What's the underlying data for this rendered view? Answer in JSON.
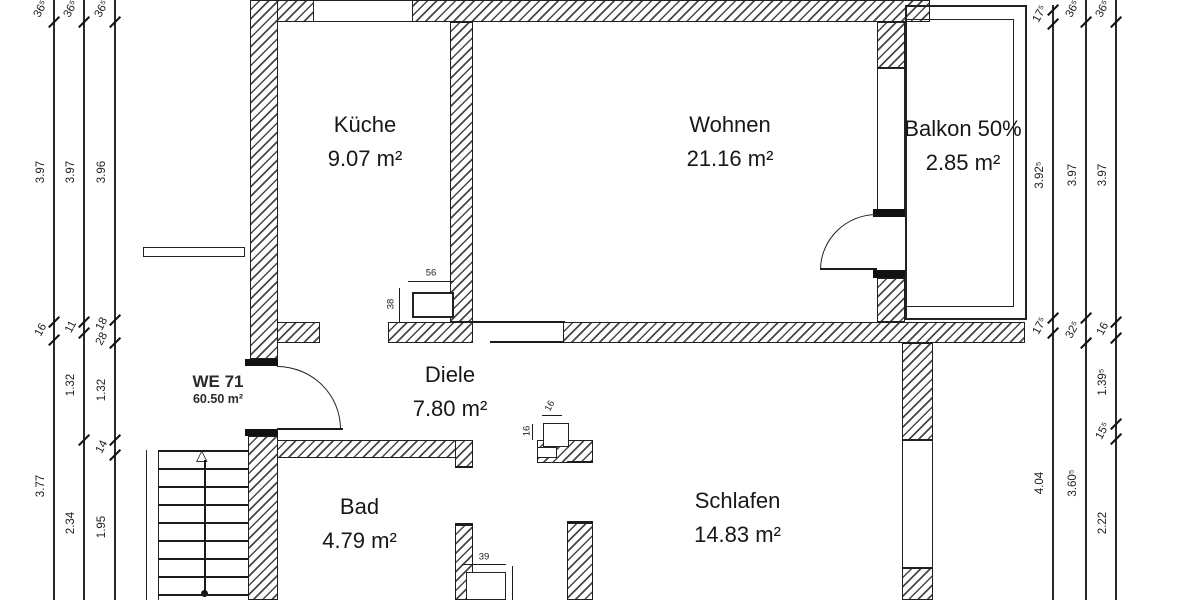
{
  "plan_title": "Wohnungsgrundriss WE 71",
  "rooms": [
    {
      "id": "kueche",
      "name": "Küche",
      "area": "9.07 m²"
    },
    {
      "id": "wohnen",
      "name": "Wohnen",
      "area": "21.16 m²"
    },
    {
      "id": "balkon",
      "name": "Balkon 50%",
      "area": "2.85 m²"
    },
    {
      "id": "diele",
      "name": "Diele",
      "area": "7.80 m²"
    },
    {
      "id": "bad",
      "name": "Bad",
      "area": "4.79 m²"
    },
    {
      "id": "schlafen",
      "name": "Schlafen",
      "area": "14.83 m²"
    }
  ],
  "unit": {
    "label": "WE 71",
    "area": "60.50 m²"
  },
  "dimensions": [
    {
      "side": "left",
      "x": 53,
      "top": 0,
      "bottom": 600,
      "ticks": [
        22,
        322,
        340
      ],
      "labels": [
        {
          "t": "36⁵",
          "y": 9
        },
        {
          "t": "3.97",
          "y": 172
        },
        {
          "t": "16",
          "y": 330
        },
        {
          "t": "3.77",
          "y": 486
        }
      ]
    },
    {
      "side": "left",
      "x": 83,
      "top": 0,
      "bottom": 600,
      "ticks": [
        22,
        322,
        333,
        440
      ],
      "labels": [
        {
          "t": "36⁵",
          "y": 9
        },
        {
          "t": "3.97",
          "y": 172
        },
        {
          "t": "11",
          "y": 327
        },
        {
          "t": "1.32",
          "y": 385
        },
        {
          "t": "2.34",
          "y": 523
        }
      ]
    },
    {
      "side": "left",
      "x": 114,
      "top": 0,
      "bottom": 600,
      "ticks": [
        22,
        320,
        343,
        440,
        455
      ],
      "labels": [
        {
          "t": "36⁵",
          "y": 9
        },
        {
          "t": "3.96",
          "y": 172
        },
        {
          "t": "18",
          "y": 324
        },
        {
          "t": "28",
          "y": 339
        },
        {
          "t": "1.32",
          "y": 390
        },
        {
          "t": "14",
          "y": 447
        },
        {
          "t": "1.95",
          "y": 527
        }
      ]
    },
    {
      "side": "right",
      "x": 1052,
      "top": 5,
      "bottom": 600,
      "ticks": [
        10,
        24,
        318,
        333
      ],
      "labels": [
        {
          "t": "17⁵",
          "y": 14
        },
        {
          "t": "3.92⁵",
          "y": 175
        },
        {
          "t": "17⁵",
          "y": 326
        },
        {
          "t": "4.04",
          "y": 483
        }
      ]
    },
    {
      "side": "right",
      "x": 1085,
      "top": 0,
      "bottom": 600,
      "ticks": [
        22,
        318,
        343
      ],
      "labels": [
        {
          "t": "36⁵",
          "y": 9
        },
        {
          "t": "3.97",
          "y": 175
        },
        {
          "t": "32⁵",
          "y": 330
        },
        {
          "t": "3.60⁵",
          "y": 483
        }
      ]
    },
    {
      "side": "right",
      "x": 1115,
      "top": 0,
      "bottom": 600,
      "ticks": [
        22,
        322,
        338,
        424,
        439
      ],
      "labels": [
        {
          "t": "36⁵",
          "y": 9
        },
        {
          "t": "3.97",
          "y": 175
        },
        {
          "t": "16",
          "y": 329
        },
        {
          "t": "1.39⁵",
          "y": 382
        },
        {
          "t": "15⁵",
          "y": 431
        },
        {
          "t": "2.22",
          "y": 523
        }
      ]
    }
  ],
  "details": {
    "chimney_width": "56",
    "chimney_height": "38",
    "niche_a": "16",
    "niche_b": "16",
    "bad_step": "39"
  },
  "stairs": {
    "arrow_glyph": "△",
    "treads_y": [
      450,
      468,
      486,
      504,
      522,
      540,
      558,
      576,
      594
    ]
  }
}
